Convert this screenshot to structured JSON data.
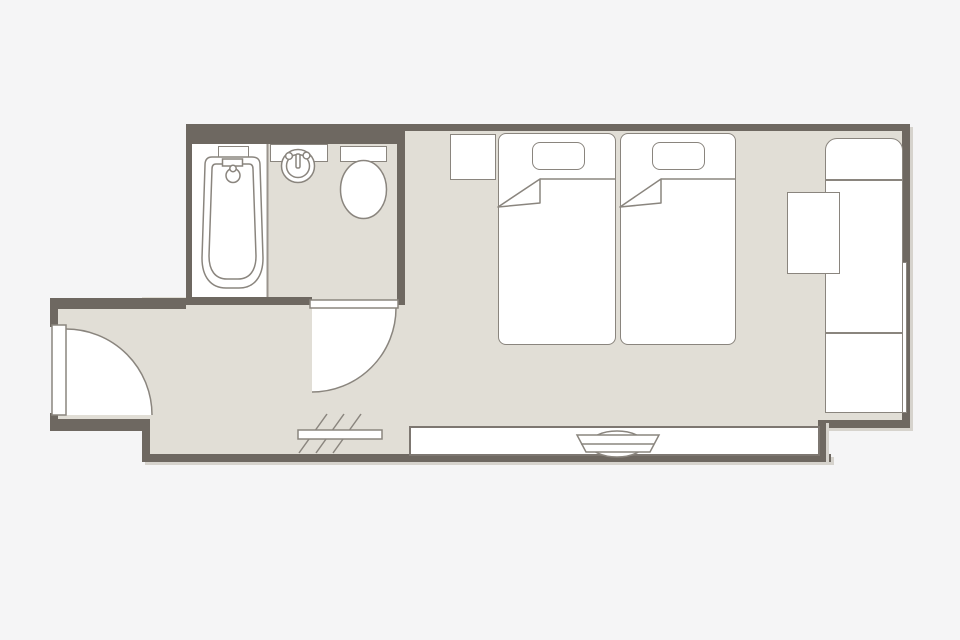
{
  "colors": {
    "background": "#f5f5f6",
    "wall": "#6e6861",
    "floor": "#e1ded6",
    "outline": "#8a857e",
    "fixture_fill": "#ffffff"
  },
  "rooms": {
    "bathroom": "bathroom",
    "bedroom": "bedroom",
    "hallway": "entry hallway",
    "shower_room": "bath area"
  },
  "fixtures": {
    "bathtub": "bathtub",
    "washbasin": "washbasin",
    "toilet": "toilet",
    "entrance_door": "entrance door",
    "bathroom_door": "bathroom door",
    "bed_left": "twin bed",
    "bed_right": "twin bed",
    "pillow": "pillow",
    "nightstand": "nightstand",
    "counter_unit": "counter unit",
    "chair": "chair",
    "window_right": "window",
    "window_bottom": "window",
    "fan_coil": "fan coil unit",
    "luggage_rack": "luggage rack"
  }
}
